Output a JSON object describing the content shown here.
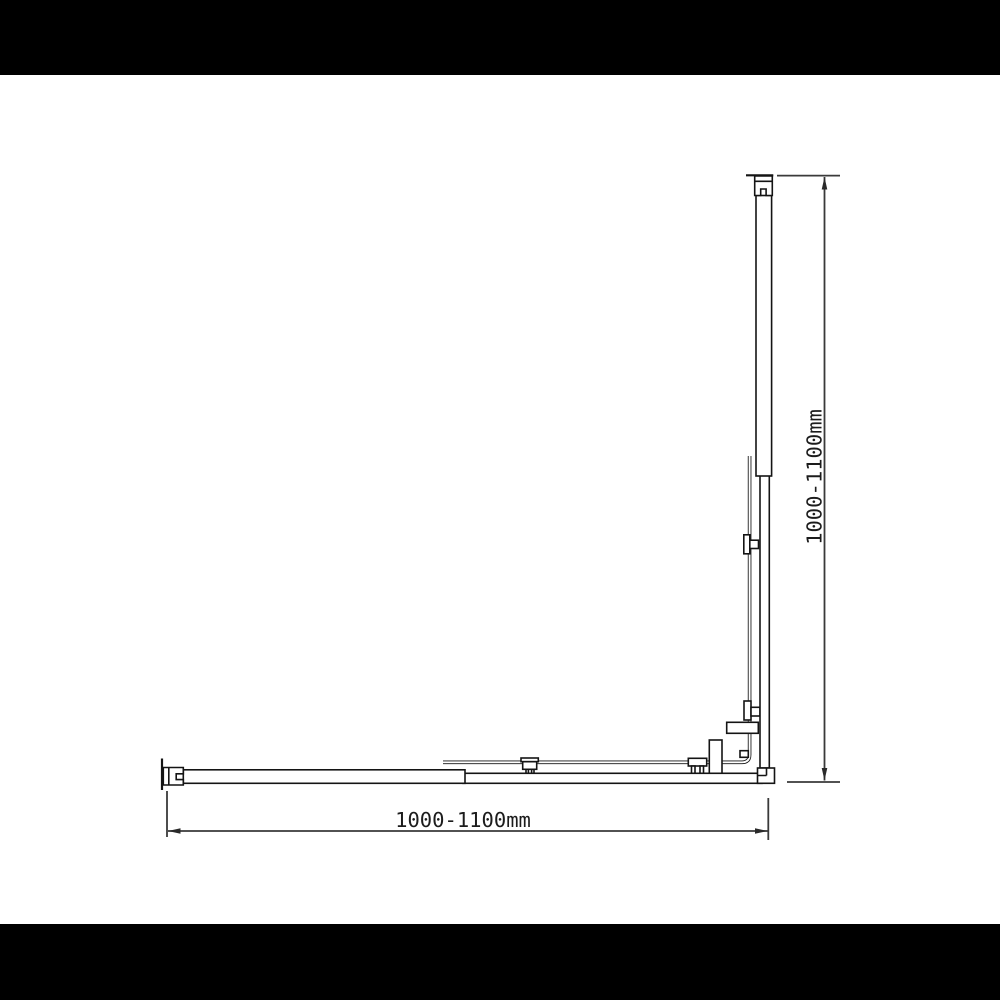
{
  "page": {
    "background_color": "#ffffff",
    "letterbox_color": "#000000"
  },
  "diagram": {
    "line_color": "#141414",
    "dimension_color": "#3a3a3a",
    "width_dimension": {
      "label": "1000-1100mm"
    },
    "height_dimension": {
      "label": "1000-1100mm"
    }
  }
}
